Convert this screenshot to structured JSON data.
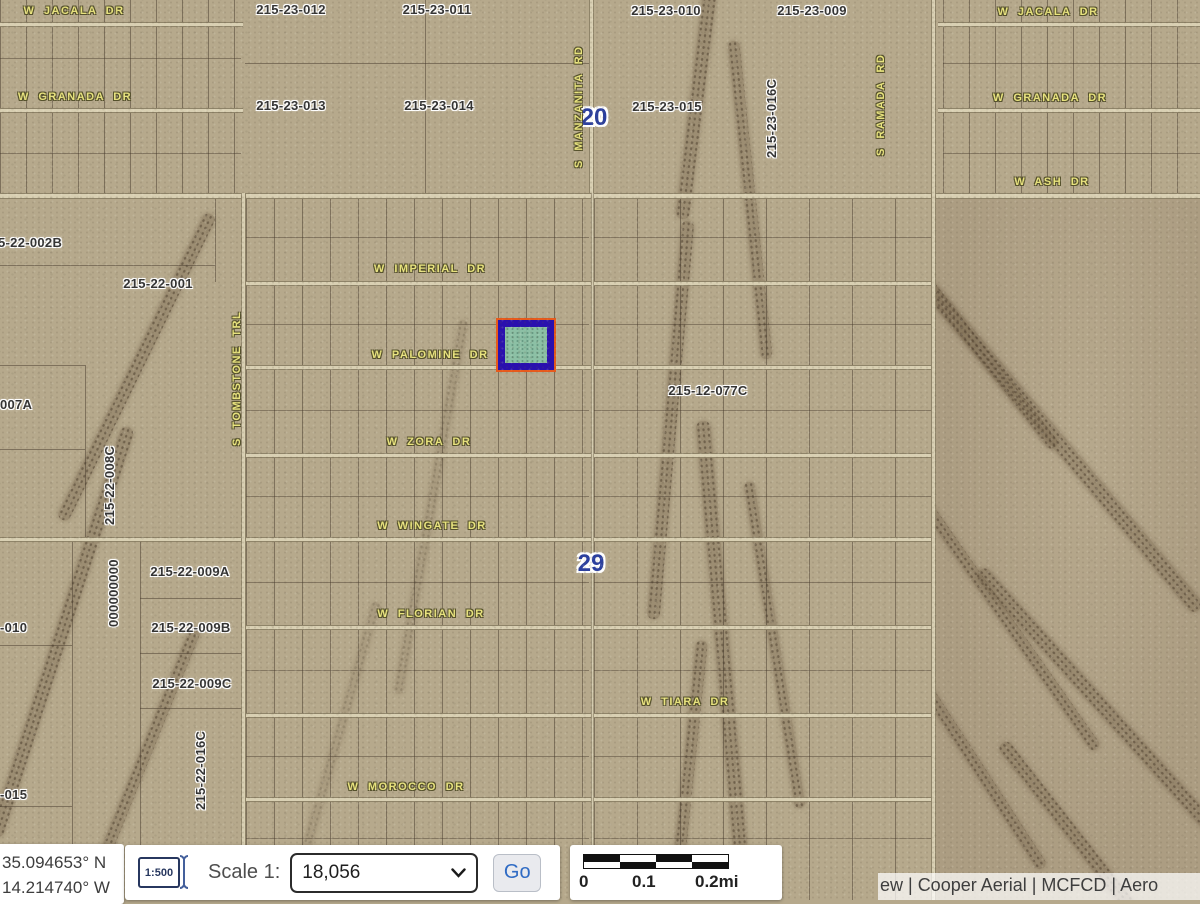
{
  "map": {
    "street_labels": {
      "jacala_left": "W JACALA DR",
      "jacala_right": "W JACALA DR",
      "granada_left": "W GRANADA DR",
      "granada_right": "W GRANADA DR",
      "ash": "W ASH DR",
      "imperial": "W IMPERIAL DR",
      "palomine": "W PALOMINE DR",
      "zora": "W ZORA DR",
      "wingate": "W WINGATE DR",
      "florian": "W FLORIAN DR",
      "tiara": "W TIARA DR",
      "morocco": "W MOROCCO DR",
      "manzanita": "S MANZANITA RD",
      "ramada": "S RAMADA RD",
      "tombstone": "S TOMBSTONE TRL"
    },
    "parcel_labels": {
      "p23_012": "215-23-012",
      "p23_011": "215-23-011",
      "p23_010": "215-23-010",
      "p23_009": "215-23-009",
      "p23_013": "215-23-013",
      "p23_014": "215-23-014",
      "p23_015": "215-23-015",
      "p23_016c": "215-23-016C",
      "p22_002b": "5-22-002B",
      "p22_001": "215-22-001",
      "p22_007a": "007A",
      "p22_008c": "215-22-008C",
      "p12_077c": "215-12-077C",
      "p22_009a": "215-22-009A",
      "p22_009b": "215-22-009B",
      "p22_009c": "215-22-009C",
      "p22_016c": "215-22-016C",
      "p010": "-010",
      "p015": "-015",
      "zeros": "000000000"
    },
    "section_labels": {
      "sec20": "20",
      "sec29": "29"
    },
    "highlight_colors": {
      "outer": "#e75a1c",
      "border": "#2a10ae",
      "fill": "#86c3a8"
    }
  },
  "statusbar": {
    "coordinates": {
      "lat": "35.094653° N",
      "lon": "14.214740° W"
    },
    "scale_widget": {
      "icon_label": "1:500",
      "label": "Scale 1:",
      "value": "18,056",
      "go": "Go"
    },
    "scalebar": {
      "t0": "0",
      "t1": "0.1",
      "t2": "0.2mi"
    },
    "attribution": "ew | Cooper Aerial | MCFCD | Aero"
  }
}
